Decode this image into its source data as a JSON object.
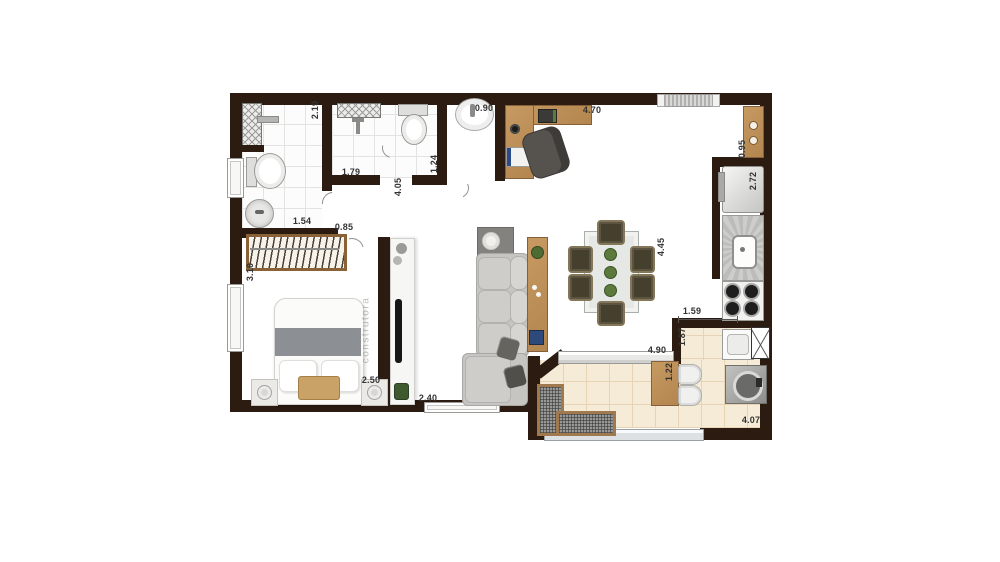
{
  "plan_title": "apartment-floor-plan",
  "watermark": "construtora",
  "colors": {
    "wall": "#2b1b10",
    "wood": "#dccbbd",
    "tile": "#fcfcfc",
    "tile-line": "#e3e3e1",
    "btile": "#f6ebd7",
    "btile-line": "#e6d4b4",
    "wood-furn": "#b3854f",
    "wood-furn-dark": "#86603a",
    "green": "#56743a"
  },
  "dimensions": [
    {
      "v": "2.19",
      "x": 315,
      "y": 110,
      "r": 1
    },
    {
      "v": "0.90",
      "x": 484,
      "y": 108,
      "r": 0
    },
    {
      "v": "4.70",
      "x": 592,
      "y": 110,
      "r": 0
    },
    {
      "v": "0.95",
      "x": 742,
      "y": 149,
      "r": 1
    },
    {
      "v": "2.72",
      "x": 753,
      "y": 181,
      "r": 1
    },
    {
      "v": "1.79",
      "x": 351,
      "y": 172,
      "r": 0
    },
    {
      "v": "1.24",
      "x": 434,
      "y": 164,
      "r": 1
    },
    {
      "v": "4.05",
      "x": 398,
      "y": 187,
      "r": 1
    },
    {
      "v": "1.54",
      "x": 302,
      "y": 221,
      "r": 0
    },
    {
      "v": "0.85",
      "x": 344,
      "y": 227,
      "r": 0
    },
    {
      "v": "3.10",
      "x": 250,
      "y": 272,
      "r": 1
    },
    {
      "v": "2.50",
      "x": 371,
      "y": 380,
      "r": 0
    },
    {
      "v": "2.40",
      "x": 428,
      "y": 398,
      "r": 0
    },
    {
      "v": "4.45",
      "x": 661,
      "y": 247,
      "r": 1
    },
    {
      "v": "4.90",
      "x": 657,
      "y": 350,
      "r": 0
    },
    {
      "v": "1.59",
      "x": 692,
      "y": 311,
      "r": 0
    },
    {
      "v": "1.87",
      "x": 682,
      "y": 337,
      "r": 1
    },
    {
      "v": "1.22",
      "x": 669,
      "y": 372,
      "r": 1
    },
    {
      "v": "4.07",
      "x": 751,
      "y": 420,
      "r": 0
    }
  ]
}
